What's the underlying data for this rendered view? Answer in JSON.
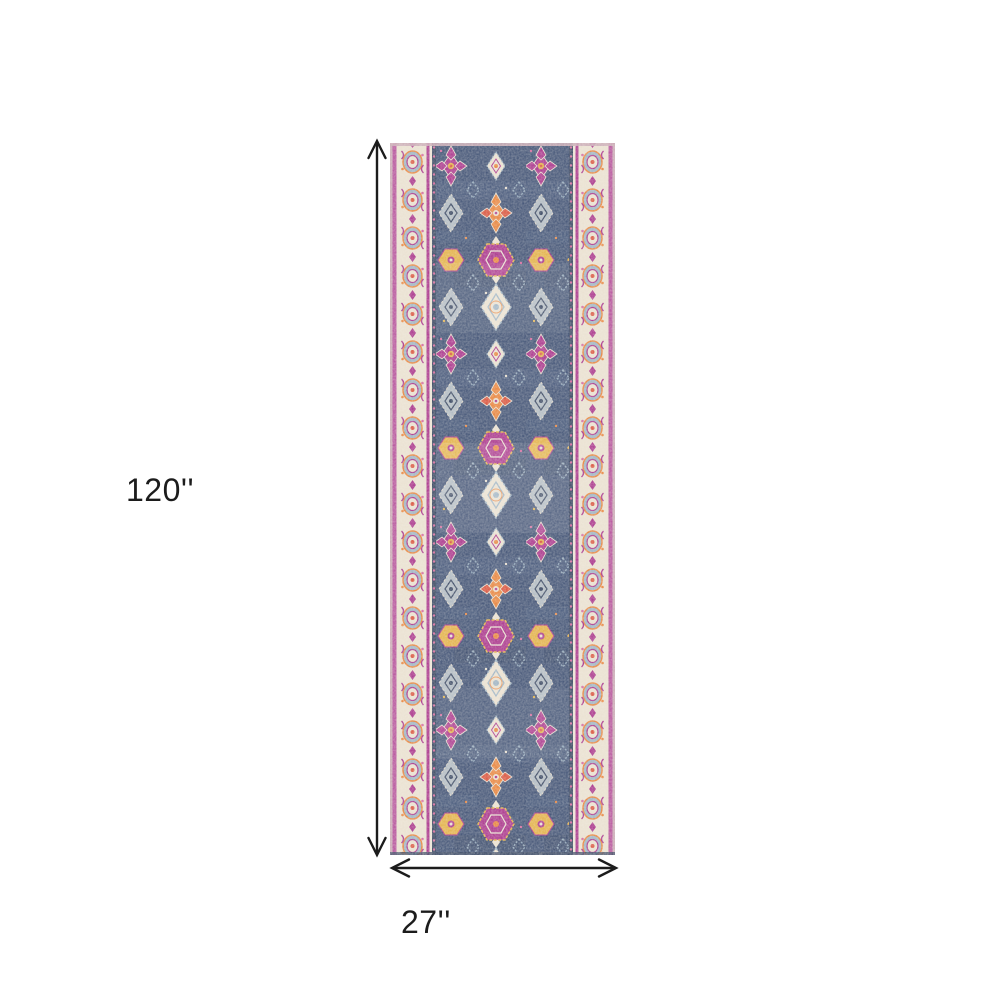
{
  "diagram": {
    "height_label": "120''",
    "width_label": "27''"
  },
  "rug": {
    "description": "Vintage Persian-style runner rug: distressed navy field with rows of cream diamond medallions, magenta cross flowers, orange crosses and yellow hexagon motifs, framed by ornate cream side borders with magenta stripes"
  },
  "colors": {
    "background": "#ffffff",
    "arrow": "#1c1c1c",
    "label-text": "#1c1c1c",
    "navy": "#3d4f73",
    "navy-dark": "#33425f",
    "navy-light": "#55688f",
    "cream": "#eae1d1",
    "magenta": "#a8308a",
    "pink": "#d4659c",
    "orange": "#e8823a",
    "red-orange": "#d9503a",
    "yellow": "#e3b045",
    "pale-blue": "#9db3c4",
    "grey-blue": "#bac4ca",
    "edge-pink": "#c9a8b5"
  }
}
